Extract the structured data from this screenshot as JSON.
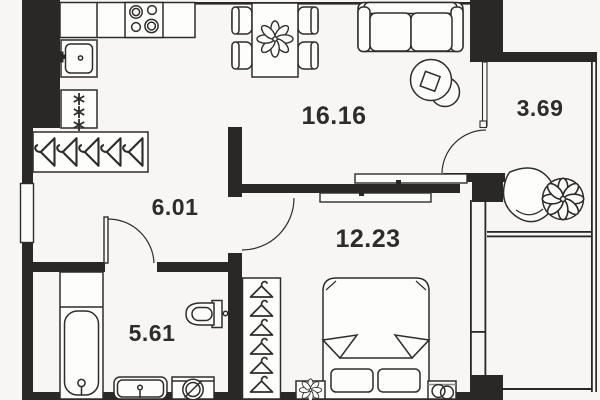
{
  "plan": {
    "title": "apartment-floor-plan",
    "colors": {
      "background": "#f7f6f4",
      "walls": "#2a2826",
      "furniture_lines": "#2f2d2b",
      "text": "#2e2c2a"
    },
    "rooms": {
      "living_kitchen": {
        "name": "living-kitchen",
        "area": "16.16"
      },
      "balcony": {
        "name": "balcony",
        "area": "3.69"
      },
      "hallway": {
        "name": "hallway",
        "area": "6.01"
      },
      "bedroom": {
        "name": "bedroom",
        "area": "12.23"
      },
      "bathroom": {
        "name": "bathroom",
        "area": "5.61"
      }
    },
    "furniture": [
      "stove-icon",
      "kitchen-sink-icon",
      "refrigerator-icon",
      "dining-table-icon",
      "dining-chair-icon",
      "flower-centerpiece-icon",
      "sofa-icon",
      "coffee-table-icon",
      "hanging-chair-icon",
      "potted-plant-icon",
      "hallway-closet-hangers-icon",
      "entrance-door-icon",
      "bathtub-icon",
      "toilet-icon",
      "washbasin-icon",
      "washing-machine-icon",
      "wardrobe-hangers-icon",
      "double-bed-icon",
      "pillow-icon",
      "nightstand-flower-icon",
      "nightstand-rings-icon",
      "sliding-door-icon",
      "swing-door-icon"
    ]
  }
}
